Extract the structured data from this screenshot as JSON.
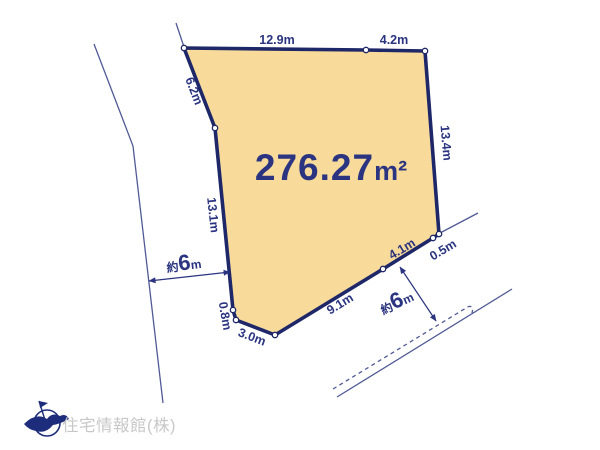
{
  "diagram": {
    "area": {
      "value": "276.27",
      "unit": "m²"
    },
    "edge_labels": {
      "top_left": "12.9m",
      "top_right": "4.2m",
      "upper_left": "6.2m",
      "right": "13.4m",
      "left": "13.1m",
      "bottom_tiny": "0.8m",
      "bottom": "3.0m",
      "bottom_diagonal": "9.1m",
      "lower_right": "4.1m",
      "right_corner": "0.5m"
    },
    "road_widths": {
      "left": {
        "prefix": "約",
        "value": "6",
        "unit": "m"
      },
      "bottom_right": {
        "prefix": "約",
        "value": "6",
        "unit": "m"
      }
    },
    "company_name": "住宅情報館(株)",
    "colors": {
      "plot_fill": "#f8db9b",
      "plot_border": "#1e2768",
      "dimension_text": "#2a3480",
      "road_line": "#505a96",
      "company_text": "#c8c8c8",
      "logo": "#1e2d7b"
    }
  }
}
